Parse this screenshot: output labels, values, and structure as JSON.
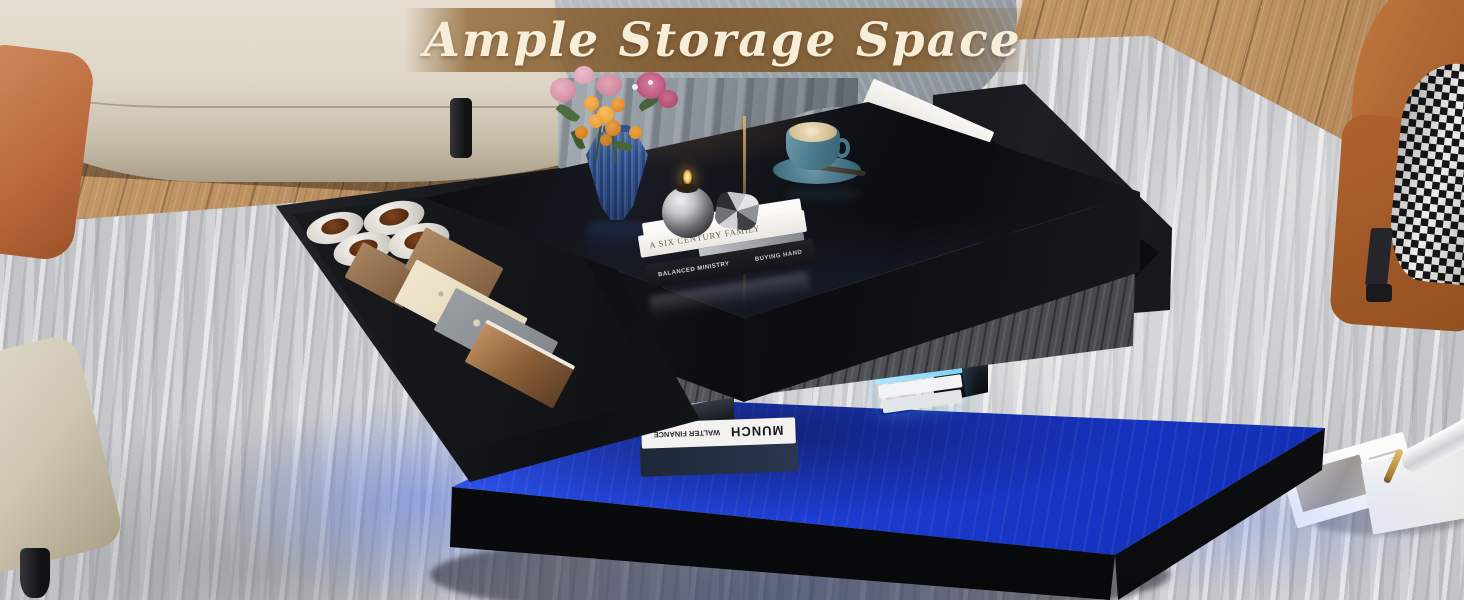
{
  "banner": {
    "title": "Ample Storage Space",
    "bg_color": "#7c5426",
    "text_color": "#f6eed8"
  },
  "tabletop_books": {
    "top": "A SIX CENTURY FAMILY",
    "bottom_left": "BALANCED MINISTRY",
    "bottom_right": "BUYING HAND"
  },
  "base_book": {
    "title": "MUNCH",
    "subtitle": "WALTER FINANCE"
  },
  "right_drawer": {
    "pink_box_brand": "Robusta",
    "pink_box_sub": "coffe",
    "white_pack_text": "ROBUSTA"
  },
  "colors": {
    "led_blue": "#2448e0",
    "table_black": "#0b0c0f",
    "table_grain_gray": "#55585d",
    "rug_gray": "#c7c8ca",
    "wood_floor": "#b2875a",
    "sofa_beige": "#ddd5c5",
    "pillow_terracotta": "#b96a3c",
    "armchair_leather": "#a05a28",
    "cup_teal": "#4d7e91",
    "vase_blue": "#3a5a94",
    "latte_foam": "#d9c49a",
    "robusta_pink": "#e9c6ad",
    "green_box": "#22795a"
  }
}
